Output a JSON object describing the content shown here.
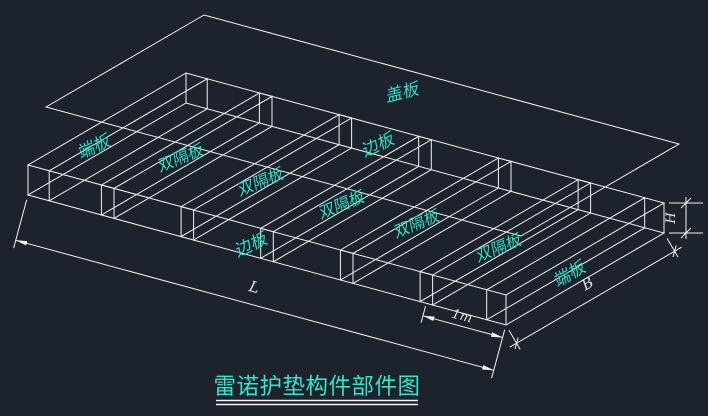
{
  "canvas": {
    "background": "#1c232c",
    "line_color": "#f2f2f2",
    "label_color": "#31dcc7",
    "dim_text_color": "#e3e3e3"
  },
  "title": {
    "text": "雷诺护垫构件部件图"
  },
  "parts": {
    "cover": "盖板",
    "end_left": "端板",
    "end_right": "端板",
    "side_top": "边板",
    "side_bottom": "边板",
    "diaphragms": [
      "双隔板",
      "双隔板",
      "双隔板",
      "双隔板",
      "双隔板"
    ]
  },
  "dims": {
    "length": "L",
    "cell": "1m",
    "width": "B",
    "height": "H"
  }
}
